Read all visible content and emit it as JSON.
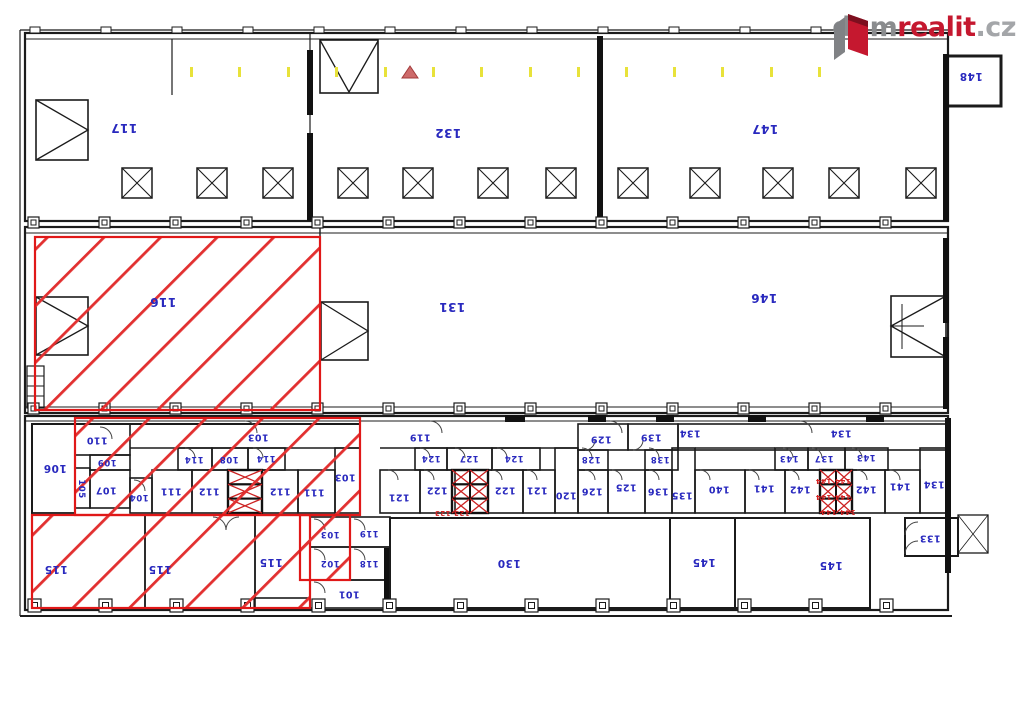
{
  "brand": {
    "name": "dumrealit.cz",
    "dum": "dum",
    "realit": "realit",
    "cz": ".cz",
    "accent_red": "#c5182f",
    "gray": "#8a8c8e"
  },
  "plan": {
    "label_color": "#2828be",
    "highlight_color": "#e01818",
    "highlighted_unit_labels": [
      "116",
      "115",
      "110",
      "109",
      "105",
      "107",
      "104",
      "111",
      "112",
      "114",
      "108",
      "103",
      "102"
    ],
    "labels": [
      {
        "t": "117",
        "x": 124,
        "y": 128,
        "s": 12
      },
      {
        "t": "132",
        "x": 448,
        "y": 133,
        "s": 12
      },
      {
        "t": "147",
        "x": 765,
        "y": 129,
        "s": 12
      },
      {
        "t": "148",
        "x": 971,
        "y": 76,
        "s": 10.5
      },
      {
        "t": "116",
        "x": 163,
        "y": 302,
        "s": 12
      },
      {
        "t": "131",
        "x": 452,
        "y": 307,
        "s": 12
      },
      {
        "t": "146",
        "x": 764,
        "y": 298,
        "s": 12
      },
      {
        "t": "110",
        "x": 97,
        "y": 440,
        "s": 9.5
      },
      {
        "t": "106",
        "x": 55,
        "y": 468,
        "s": 10.5
      },
      {
        "t": "109",
        "x": 107,
        "y": 462,
        "s": 8.5
      },
      {
        "t": "105",
        "x": 81,
        "y": 489,
        "s": 8.5,
        "r": 90
      },
      {
        "t": "107",
        "x": 106,
        "y": 490,
        "s": 9.5
      },
      {
        "t": "104",
        "x": 139,
        "y": 497,
        "s": 8.5
      },
      {
        "t": "111",
        "x": 171,
        "y": 491,
        "s": 9.5
      },
      {
        "t": "112",
        "x": 209,
        "y": 491,
        "s": 9.5
      },
      {
        "t": "114",
        "x": 194,
        "y": 459,
        "s": 8.5
      },
      {
        "t": "108",
        "x": 229,
        "y": 459,
        "s": 8.5
      },
      {
        "t": "114",
        "x": 266,
        "y": 458,
        "s": 8.5
      },
      {
        "t": "112",
        "x": 280,
        "y": 491,
        "s": 9.5
      },
      {
        "t": "111",
        "x": 314,
        "y": 492,
        "s": 9.5
      },
      {
        "t": "103",
        "x": 258,
        "y": 437,
        "s": 9.5
      },
      {
        "t": "103",
        "x": 345,
        "y": 477,
        "s": 9.5
      },
      {
        "t": "119",
        "x": 420,
        "y": 437,
        "s": 9.5
      },
      {
        "t": "124",
        "x": 431,
        "y": 458,
        "s": 8.5
      },
      {
        "t": "127",
        "x": 469,
        "y": 458,
        "s": 8.5
      },
      {
        "t": "124",
        "x": 514,
        "y": 458,
        "s": 8.5
      },
      {
        "t": "121",
        "x": 399,
        "y": 497,
        "s": 9.5
      },
      {
        "t": "122",
        "x": 437,
        "y": 490,
        "s": 9.5
      },
      {
        "t": "122",
        "x": 505,
        "y": 490,
        "s": 9.5
      },
      {
        "t": "121",
        "x": 537,
        "y": 490,
        "s": 9.5
      },
      {
        "t": "120",
        "x": 566,
        "y": 495,
        "s": 9.5
      },
      {
        "t": "126",
        "x": 592,
        "y": 491,
        "s": 9.5
      },
      {
        "t": "125",
        "x": 626,
        "y": 487,
        "s": 9.5
      },
      {
        "t": "136",
        "x": 658,
        "y": 491,
        "s": 9.5
      },
      {
        "t": "135",
        "x": 682,
        "y": 495,
        "s": 9.5
      },
      {
        "t": "128",
        "x": 591,
        "y": 459,
        "s": 8.5
      },
      {
        "t": "138",
        "x": 660,
        "y": 459,
        "s": 8.5
      },
      {
        "t": "129",
        "x": 601,
        "y": 439,
        "s": 9.5
      },
      {
        "t": "139",
        "x": 651,
        "y": 437,
        "s": 9.5
      },
      {
        "t": "134",
        "x": 690,
        "y": 433,
        "s": 9.5
      },
      {
        "t": "134",
        "x": 841,
        "y": 433,
        "s": 9.5
      },
      {
        "t": "134",
        "x": 934,
        "y": 484,
        "s": 9.5
      },
      {
        "t": "140",
        "x": 719,
        "y": 489,
        "s": 9.5
      },
      {
        "t": "141",
        "x": 764,
        "y": 488,
        "s": 9.5
      },
      {
        "t": "142",
        "x": 800,
        "y": 489,
        "s": 9.5
      },
      {
        "t": "143",
        "x": 789,
        "y": 458,
        "s": 8.5
      },
      {
        "t": "137",
        "x": 824,
        "y": 458,
        "s": 8.5
      },
      {
        "t": "143",
        "x": 866,
        "y": 457,
        "s": 8.5
      },
      {
        "t": "142",
        "x": 866,
        "y": 489,
        "s": 9.5
      },
      {
        "t": "141",
        "x": 900,
        "y": 486,
        "s": 9.5
      },
      {
        "t": "133",
        "x": 930,
        "y": 538,
        "s": 9.5
      },
      {
        "t": "115",
        "x": 56,
        "y": 569,
        "s": 10.5
      },
      {
        "t": "115",
        "x": 160,
        "y": 569,
        "s": 10.5
      },
      {
        "t": "115",
        "x": 271,
        "y": 562,
        "s": 10.5
      },
      {
        "t": "103",
        "x": 330,
        "y": 534,
        "s": 8.5
      },
      {
        "t": "119",
        "x": 369,
        "y": 533,
        "s": 8.5
      },
      {
        "t": "102",
        "x": 330,
        "y": 563,
        "s": 8.5
      },
      {
        "t": "118",
        "x": 369,
        "y": 563,
        "s": 8.5
      },
      {
        "t": "101",
        "x": 349,
        "y": 594,
        "s": 9.5
      },
      {
        "t": "130",
        "x": 509,
        "y": 563,
        "s": 10.5
      },
      {
        "t": "145",
        "x": 704,
        "y": 562,
        "s": 10.5
      },
      {
        "t": "145",
        "x": 831,
        "y": 565,
        "s": 10.5
      },
      {
        "t": "123 123",
        "x": 452,
        "y": 513,
        "s": 7,
        "c": "red"
      },
      {
        "t": "144 144",
        "x": 833,
        "y": 481,
        "s": 7,
        "c": "red"
      },
      {
        "t": "144 144",
        "x": 833,
        "y": 497,
        "s": 7,
        "c": "red"
      },
      {
        "t": "144 144",
        "x": 838,
        "y": 512,
        "s": 7,
        "c": "red"
      }
    ]
  }
}
